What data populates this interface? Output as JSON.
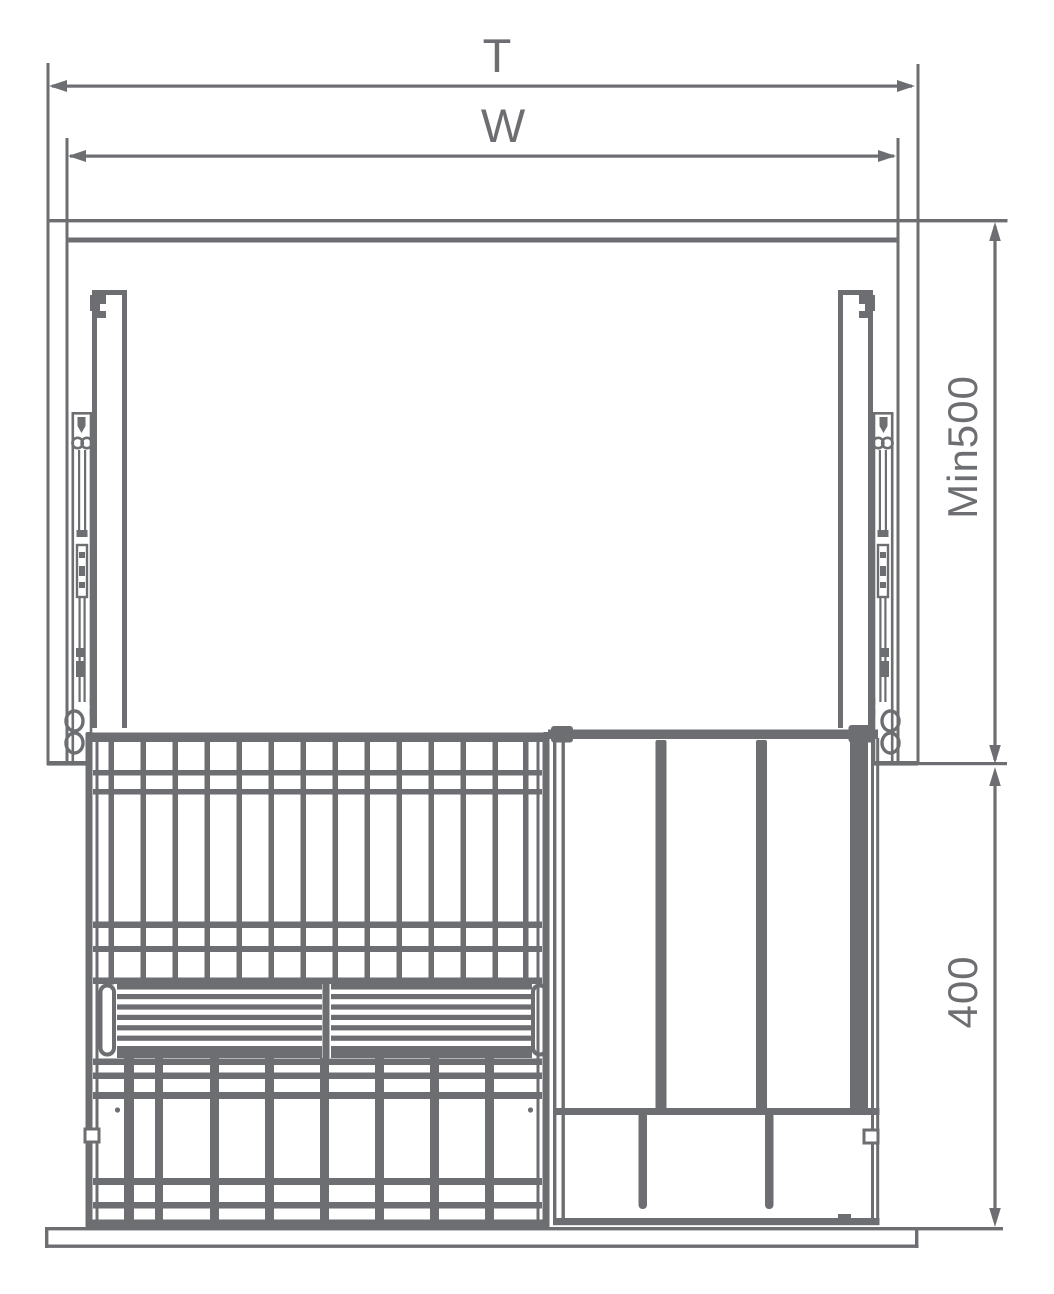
{
  "meta": {
    "description": "Technical dimension drawing, front view of a cabinet pull-out wire basket unit with slide rails, louvered tray and divider rack"
  },
  "colors": {
    "line": "#6d6e71",
    "background": "#ffffff"
  },
  "dimensions": {
    "total_width_label": "T",
    "opening_width_label": "W",
    "min_depth_label": "Min500",
    "unit_height_label": "400"
  }
}
